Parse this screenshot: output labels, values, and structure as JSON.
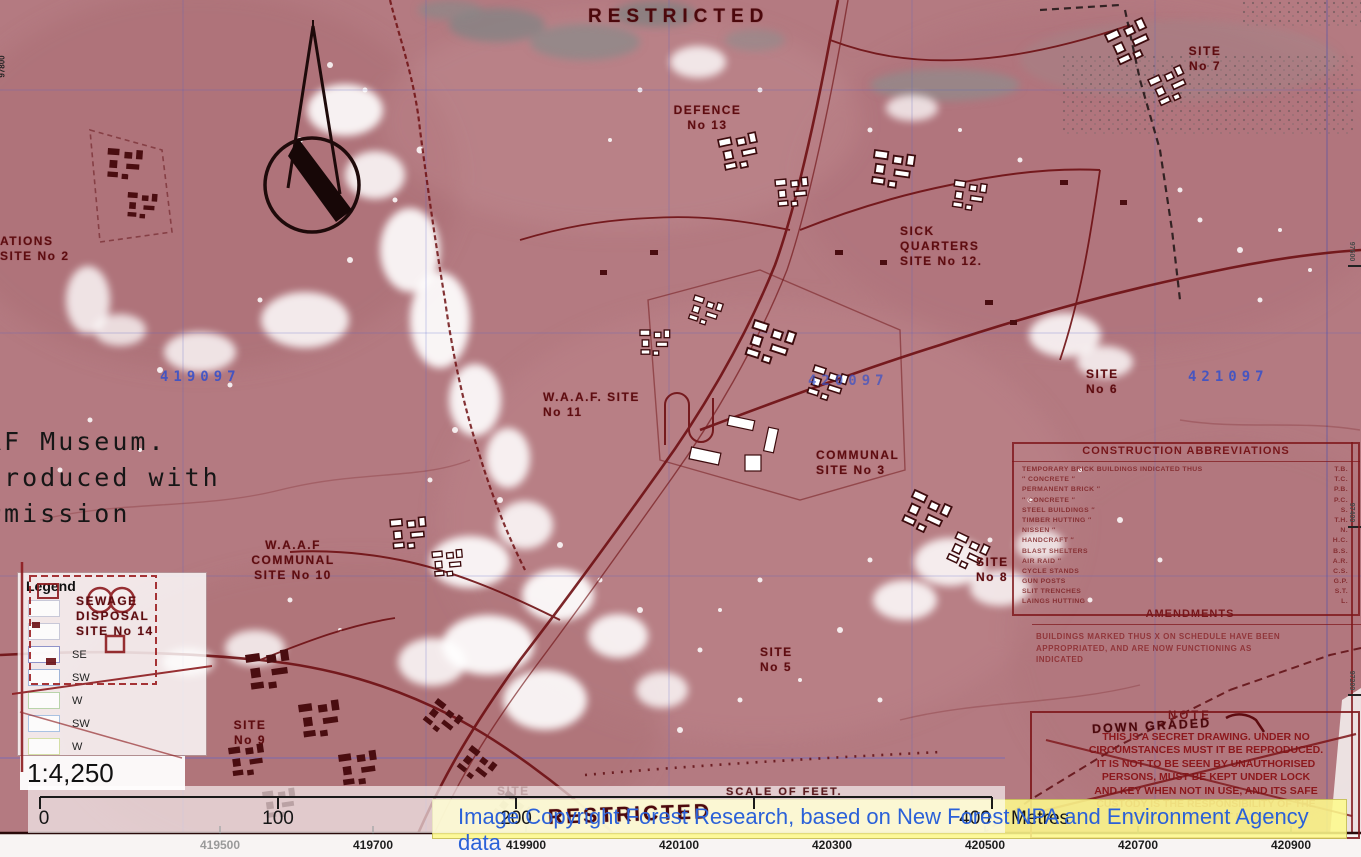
{
  "map": {
    "stamps": {
      "top": "RESTRICTED",
      "bottom": "RESTRICTED",
      "scale_of_feet": "SCALE  OF  FEET.",
      "down_graded": "DOWN GRADED"
    },
    "sites": {
      "rations": [
        "ATIONS",
        "SITE No 2"
      ],
      "defence": [
        "DEFENCE",
        "No 13"
      ],
      "sick": [
        "SICK",
        "QUARTERS",
        "SITE No 12."
      ],
      "site7": [
        "SITE",
        "No 7"
      ],
      "waaf11": [
        "W.A.A.F. SITE",
        "No 11"
      ],
      "communal3": [
        "COMMUNAL",
        "SITE  No 3"
      ],
      "site6": [
        "SITE",
        "No 6"
      ],
      "waaf10": [
        "W.A.A.F",
        "COMMUNAL",
        "SITE No 10"
      ],
      "sewage14": [
        "SEWAGE",
        "DISPOSAL",
        "SITE No 14"
      ],
      "site9": [
        "SITE",
        "No 9"
      ],
      "site8": [
        "SITE",
        "No 8"
      ],
      "site5": [
        "SITE",
        "No 5"
      ],
      "site_bottom": [
        "SITE"
      ]
    }
  },
  "museum": {
    "lines": [
      "AF Museum.",
      "produced with",
      "rmission"
    ]
  },
  "boxes": {
    "construction": {
      "title": "CONSTRUCTION  ABBREVIATIONS",
      "rows": [
        {
          "name": "TEMPORARY BRICK BUILDINGS    INDICATED THUS",
          "abbr": "T.B."
        },
        {
          "name": "″   CONCRETE   ″",
          "abbr": "T.C."
        },
        {
          "name": "PERMANENT BRICK   ″",
          "abbr": "P.B."
        },
        {
          "name": "″   CONCRETE   ″",
          "abbr": "P.C."
        },
        {
          "name": "STEEL BUILDINGS   ″",
          "abbr": "S."
        },
        {
          "name": "TIMBER HUTTING   ″",
          "abbr": "T.H."
        },
        {
          "name": "NISSEN   ″",
          "abbr": "N."
        },
        {
          "name": "HANDCRAFT   ″",
          "abbr": "H.C."
        },
        {
          "name": "BLAST SHELTERS",
          "abbr": "B.S."
        },
        {
          "name": "AIR RAID   ″",
          "abbr": "A.R."
        },
        {
          "name": "CYCLE STANDS",
          "abbr": "C.S."
        },
        {
          "name": "GUN POSTS",
          "abbr": "G.P."
        },
        {
          "name": "SLIT TRENCHES",
          "abbr": "S.T."
        },
        {
          "name": "LAINGS HUTTING",
          "abbr": "L."
        }
      ]
    },
    "amendments": {
      "title": "AMENDMENTS",
      "lines": [
        "BUILDINGS MARKED THUS X ON SCHEDULE HAVE BEEN",
        "APPROPRIATED,  AND ARE NOW FUNCTIONING AS",
        "INDICATED"
      ]
    },
    "note": {
      "title": "NOTE",
      "lines": [
        "THIS IS A SECRET DRAWING. UNDER NO",
        "CIRCUMSTANCES MUST IT BE REPRODUCED.",
        "IT IS NOT TO BE SEEN BY UNAUTHORISED",
        "PERSONS, MUST BE KEPT UNDER LOCK",
        "AND KEY WHEN NOT IN USE, AND ITS SAFE",
        "CUSTODY IS THE RESPONSIBILITY OF THE",
        "PERSON TO WHOM IT IS ISSUED."
      ]
    }
  },
  "legend": {
    "title": "Legend",
    "items": [
      {
        "label": ""
      },
      {
        "label": ""
      },
      {
        "label": "SE"
      },
      {
        "label": "SW"
      },
      {
        "label": "W"
      },
      {
        "label": "SW"
      },
      {
        "label": "W"
      }
    ]
  },
  "scale": {
    "ratio_text": "1:4,250"
  },
  "scalebar": {
    "tick_labels": [
      "0",
      "100",
      "200",
      "400"
    ],
    "unit": "Metres"
  },
  "attribution": {
    "text": "Image Copyright Forest Research, based on New Forest NPA and Environment Agency data"
  },
  "grid": {
    "bottom_eastings": [
      "419500",
      "419700",
      "419900",
      "420100",
      "420300",
      "420500",
      "420700",
      "420900"
    ],
    "map_eastings": [
      "419097",
      "420097",
      "421097"
    ],
    "left_northings": [
      "97800"
    ],
    "right_northings": [
      "97600",
      "97400",
      "97200"
    ]
  },
  "colors": {
    "map_base": "#b47a81",
    "overlay_red": "#701016",
    "banner_bg": "#fdf98c",
    "banner_text": "#2b61d8",
    "grid_blue": "#3b55c6",
    "legend_se_border": "#8f93c9",
    "legend_sw_border": "#9fb4d8",
    "legend_w_border": "#b9d4aa"
  }
}
